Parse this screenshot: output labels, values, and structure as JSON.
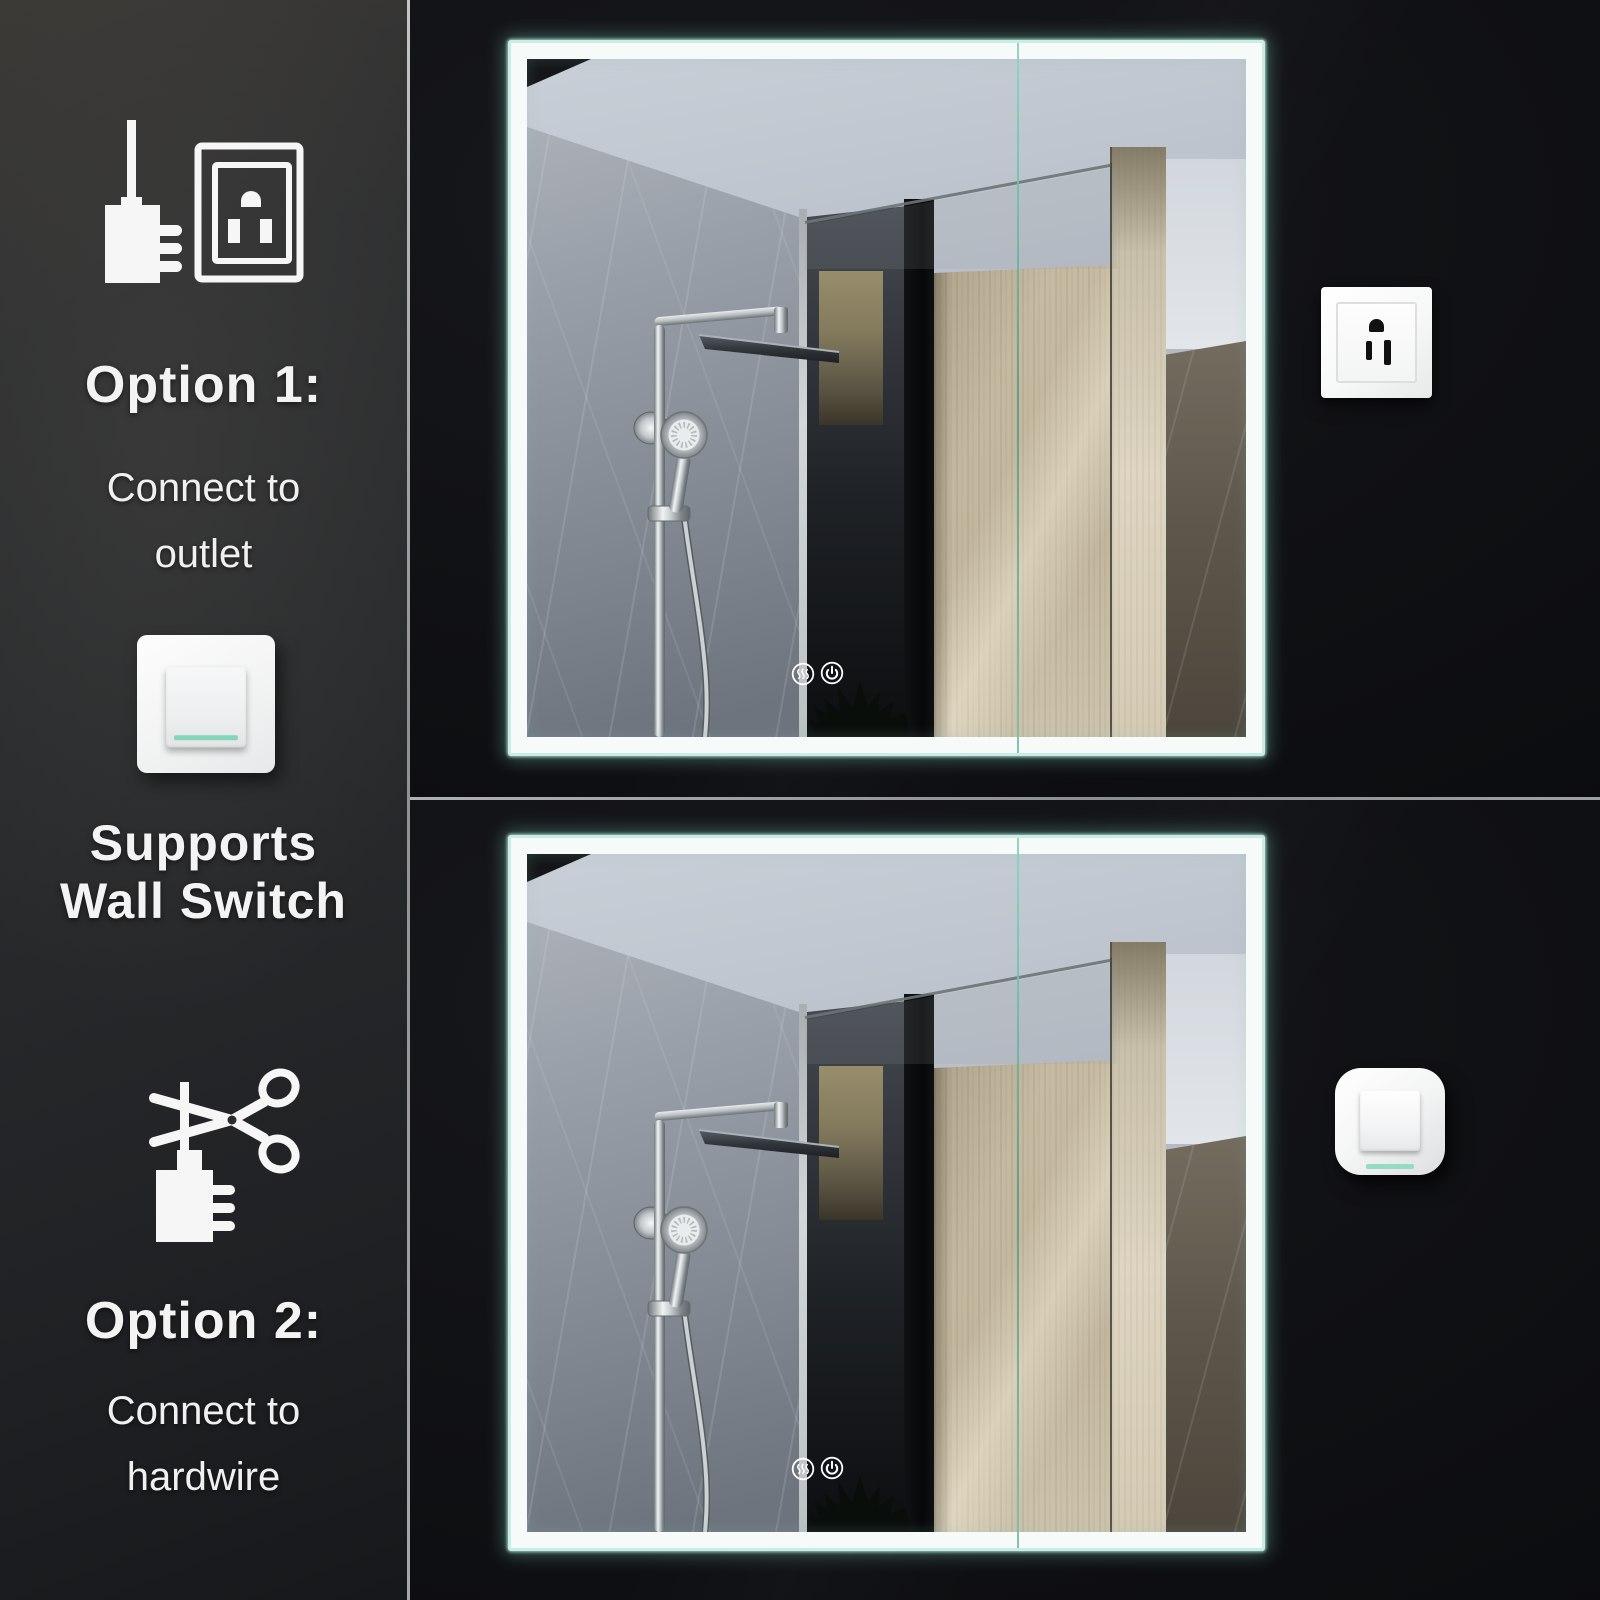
{
  "sidebar": {
    "option1": {
      "icon_plug": "power-plug-icon",
      "icon_outlet": "power-outlet-icon",
      "title": "Option 1:",
      "subtitle_line1": "Connect to",
      "subtitle_line2": "outlet"
    },
    "wall_switch": {
      "icon": "wall-switch-icon",
      "title_line1": "Supports",
      "title_line2": "Wall Switch"
    },
    "option2": {
      "icon": "scissors-cutting-cord-icon",
      "title": "Option 2:",
      "subtitle_line1": "Connect to",
      "subtitle_line2": "hardwire"
    }
  },
  "photos": {
    "top": {
      "fixture_icon": "power-outlet-graphic"
    },
    "bottom": {
      "fixture_icon": "wall-switch-graphic"
    }
  },
  "mirror": {
    "touch_icon_defogger": "defogger-icon",
    "touch_icon_power": "power-icon"
  },
  "colors": {
    "accent_mint": "#93dcc2",
    "led_glow": "#bfeee2",
    "divider_line": "#97999b",
    "sidebar_background": "#2a2c2e",
    "photo_background": "#0d0e11",
    "text": "#f3f3f3"
  }
}
